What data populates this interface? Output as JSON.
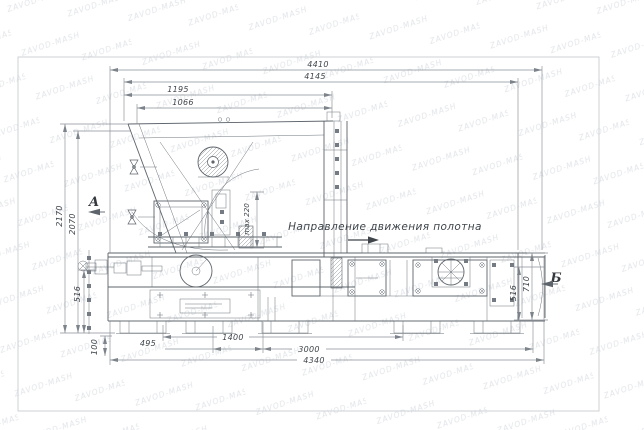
{
  "page": {
    "background": "#ffffff"
  },
  "watermark": {
    "text": "ZAVOD-MASH"
  },
  "annotations": {
    "direction_note": "Направление движения полотна",
    "view_a_label": "А",
    "view_b_label": "Б",
    "max_gap_label": "max 220"
  },
  "dimensions": {
    "top": {
      "d4410": "4410",
      "d4145": "4145",
      "d1195": "1195",
      "d1066": "1066"
    },
    "left": {
      "d2170": "2170",
      "d2070": "2070",
      "d516": "516",
      "d100": "100"
    },
    "right": {
      "d710": "710",
      "d516": "516"
    },
    "bottom": {
      "d495": "495",
      "d1400": "1400",
      "d3000": "3000",
      "d4340": "4340"
    }
  },
  "colors": {
    "machine_line": "#5d646b",
    "dim_line": "#8a9096",
    "text": "#3f454b",
    "watermark": "#e2e5e9",
    "frame": "#cdd1d6",
    "background": "#ffffff"
  }
}
